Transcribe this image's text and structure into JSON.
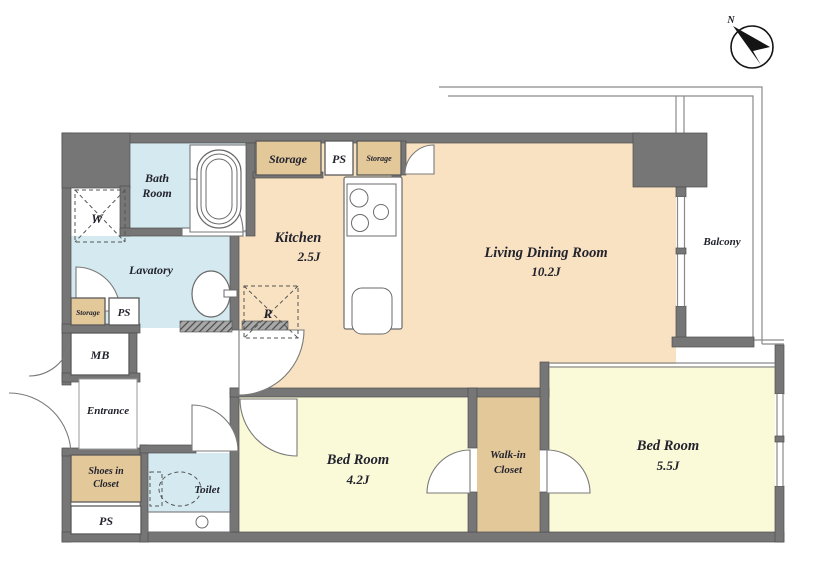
{
  "compass": {
    "north": "N"
  },
  "rooms": {
    "bath": {
      "lines": [
        "Bath",
        "Room"
      ]
    },
    "lavatory": {
      "label": "Lavatory"
    },
    "kitchen": {
      "label": "Kitchen",
      "size": "2.5J"
    },
    "living": {
      "label": "Living Dining Room",
      "size": "10.2J"
    },
    "balcony": {
      "label": "Balcony"
    },
    "bedroom_small": {
      "label": "Bed Room",
      "size": "4.2J"
    },
    "bedroom_large": {
      "label": "Bed Room",
      "size": "5.5J"
    },
    "walkin_closet": {
      "lines": [
        "Walk-in",
        "Closet"
      ]
    },
    "entrance": {
      "label": "Entrance"
    },
    "toilet": {
      "label": "Toilet"
    }
  },
  "closets": {
    "shoes": {
      "lines": [
        "Shoes in",
        "Closet"
      ]
    },
    "storage_top": "Storage",
    "storage_top_small": "Storage",
    "storage_side": "Storage"
  },
  "utilities": {
    "mb": "MB",
    "ps_top": "PS",
    "ps_side": "PS",
    "ps_bottom": "PS",
    "washer": "W",
    "fridge": "R"
  },
  "colors": {
    "wall": "#767676",
    "floor_living_dining": "#F9E2C2",
    "floor_bedroom": "#FAF9D8",
    "floor_wet_area": "#D5EAF0",
    "floor_closet": "#E3C89A",
    "line": "#555555"
  }
}
